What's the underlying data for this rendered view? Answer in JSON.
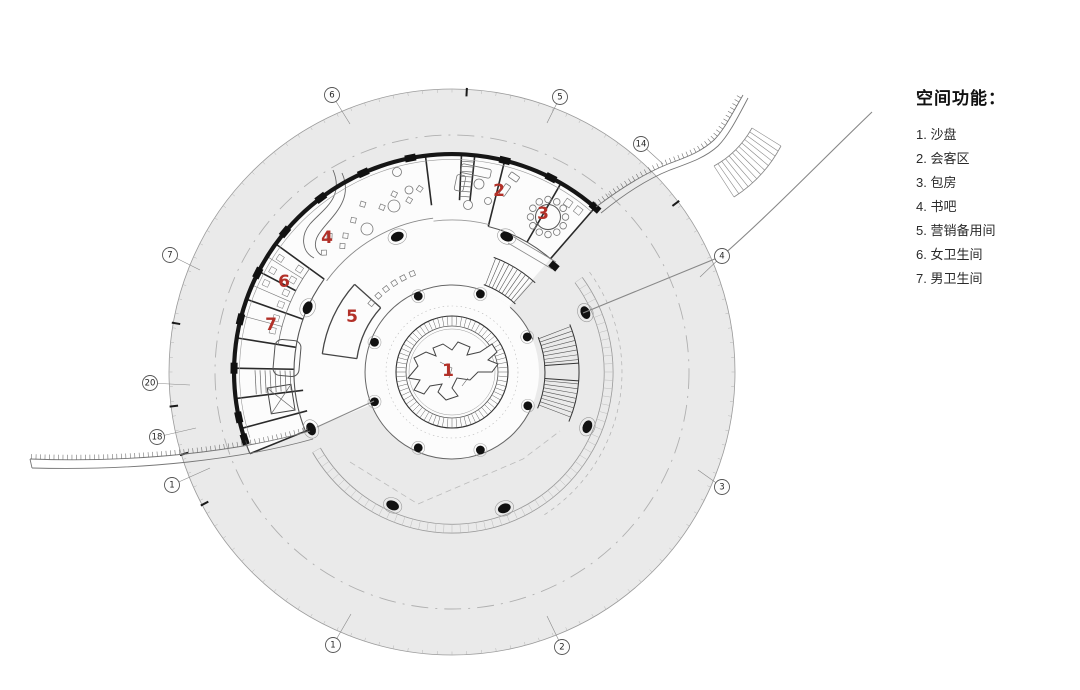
{
  "legend": {
    "title": "空间功能：",
    "items": [
      {
        "num": "1",
        "label": "沙盘"
      },
      {
        "num": "2",
        "label": "会客区"
      },
      {
        "num": "3",
        "label": "包房"
      },
      {
        "num": "4",
        "label": "书吧"
      },
      {
        "num": "5",
        "label": "营销备用间"
      },
      {
        "num": "6",
        "label": "女卫生间"
      },
      {
        "num": "7",
        "label": "男卫生间"
      }
    ]
  },
  "plan": {
    "room_markers": [
      {
        "label": "1",
        "x": 448,
        "y": 371
      },
      {
        "label": "2",
        "x": 499,
        "y": 191
      },
      {
        "label": "3",
        "x": 543,
        "y": 214
      },
      {
        "label": "4",
        "x": 327,
        "y": 238
      },
      {
        "label": "5",
        "x": 352,
        "y": 317
      },
      {
        "label": "6",
        "x": 284,
        "y": 282
      },
      {
        "label": "7",
        "x": 271,
        "y": 325
      }
    ],
    "grid_bubbles": [
      {
        "label": "6",
        "x": 332,
        "y": 95,
        "tx": 350,
        "ty": 124
      },
      {
        "label": "5",
        "x": 560,
        "y": 97,
        "tx": 547,
        "ty": 123
      },
      {
        "label": "14",
        "x": 641,
        "y": 144,
        "tx": 663,
        "ty": 164
      },
      {
        "label": "4",
        "x": 722,
        "y": 256,
        "tx": 700,
        "ty": 277
      },
      {
        "label": "3",
        "x": 722,
        "y": 487,
        "tx": 698,
        "ty": 470
      },
      {
        "label": "2",
        "x": 562,
        "y": 647,
        "tx": 547,
        "ty": 616
      },
      {
        "label": "1",
        "x": 333,
        "y": 645,
        "tx": 351,
        "ty": 614
      },
      {
        "label": "1",
        "x": 172,
        "y": 485,
        "tx": 210,
        "ty": 468
      },
      {
        "label": "18",
        "x": 157,
        "y": 437,
        "tx": 196,
        "ty": 428
      },
      {
        "label": "20",
        "x": 150,
        "y": 383,
        "tx": 190,
        "ty": 385
      },
      {
        "label": "7",
        "x": 170,
        "y": 255,
        "tx": 200,
        "ty": 270
      }
    ],
    "colors": {
      "site_fill": "#eaeaea",
      "building_fill": "#fcfcfc",
      "wall": "#161616",
      "marker_red": "#b23028",
      "line": "#9a9a9a"
    }
  }
}
